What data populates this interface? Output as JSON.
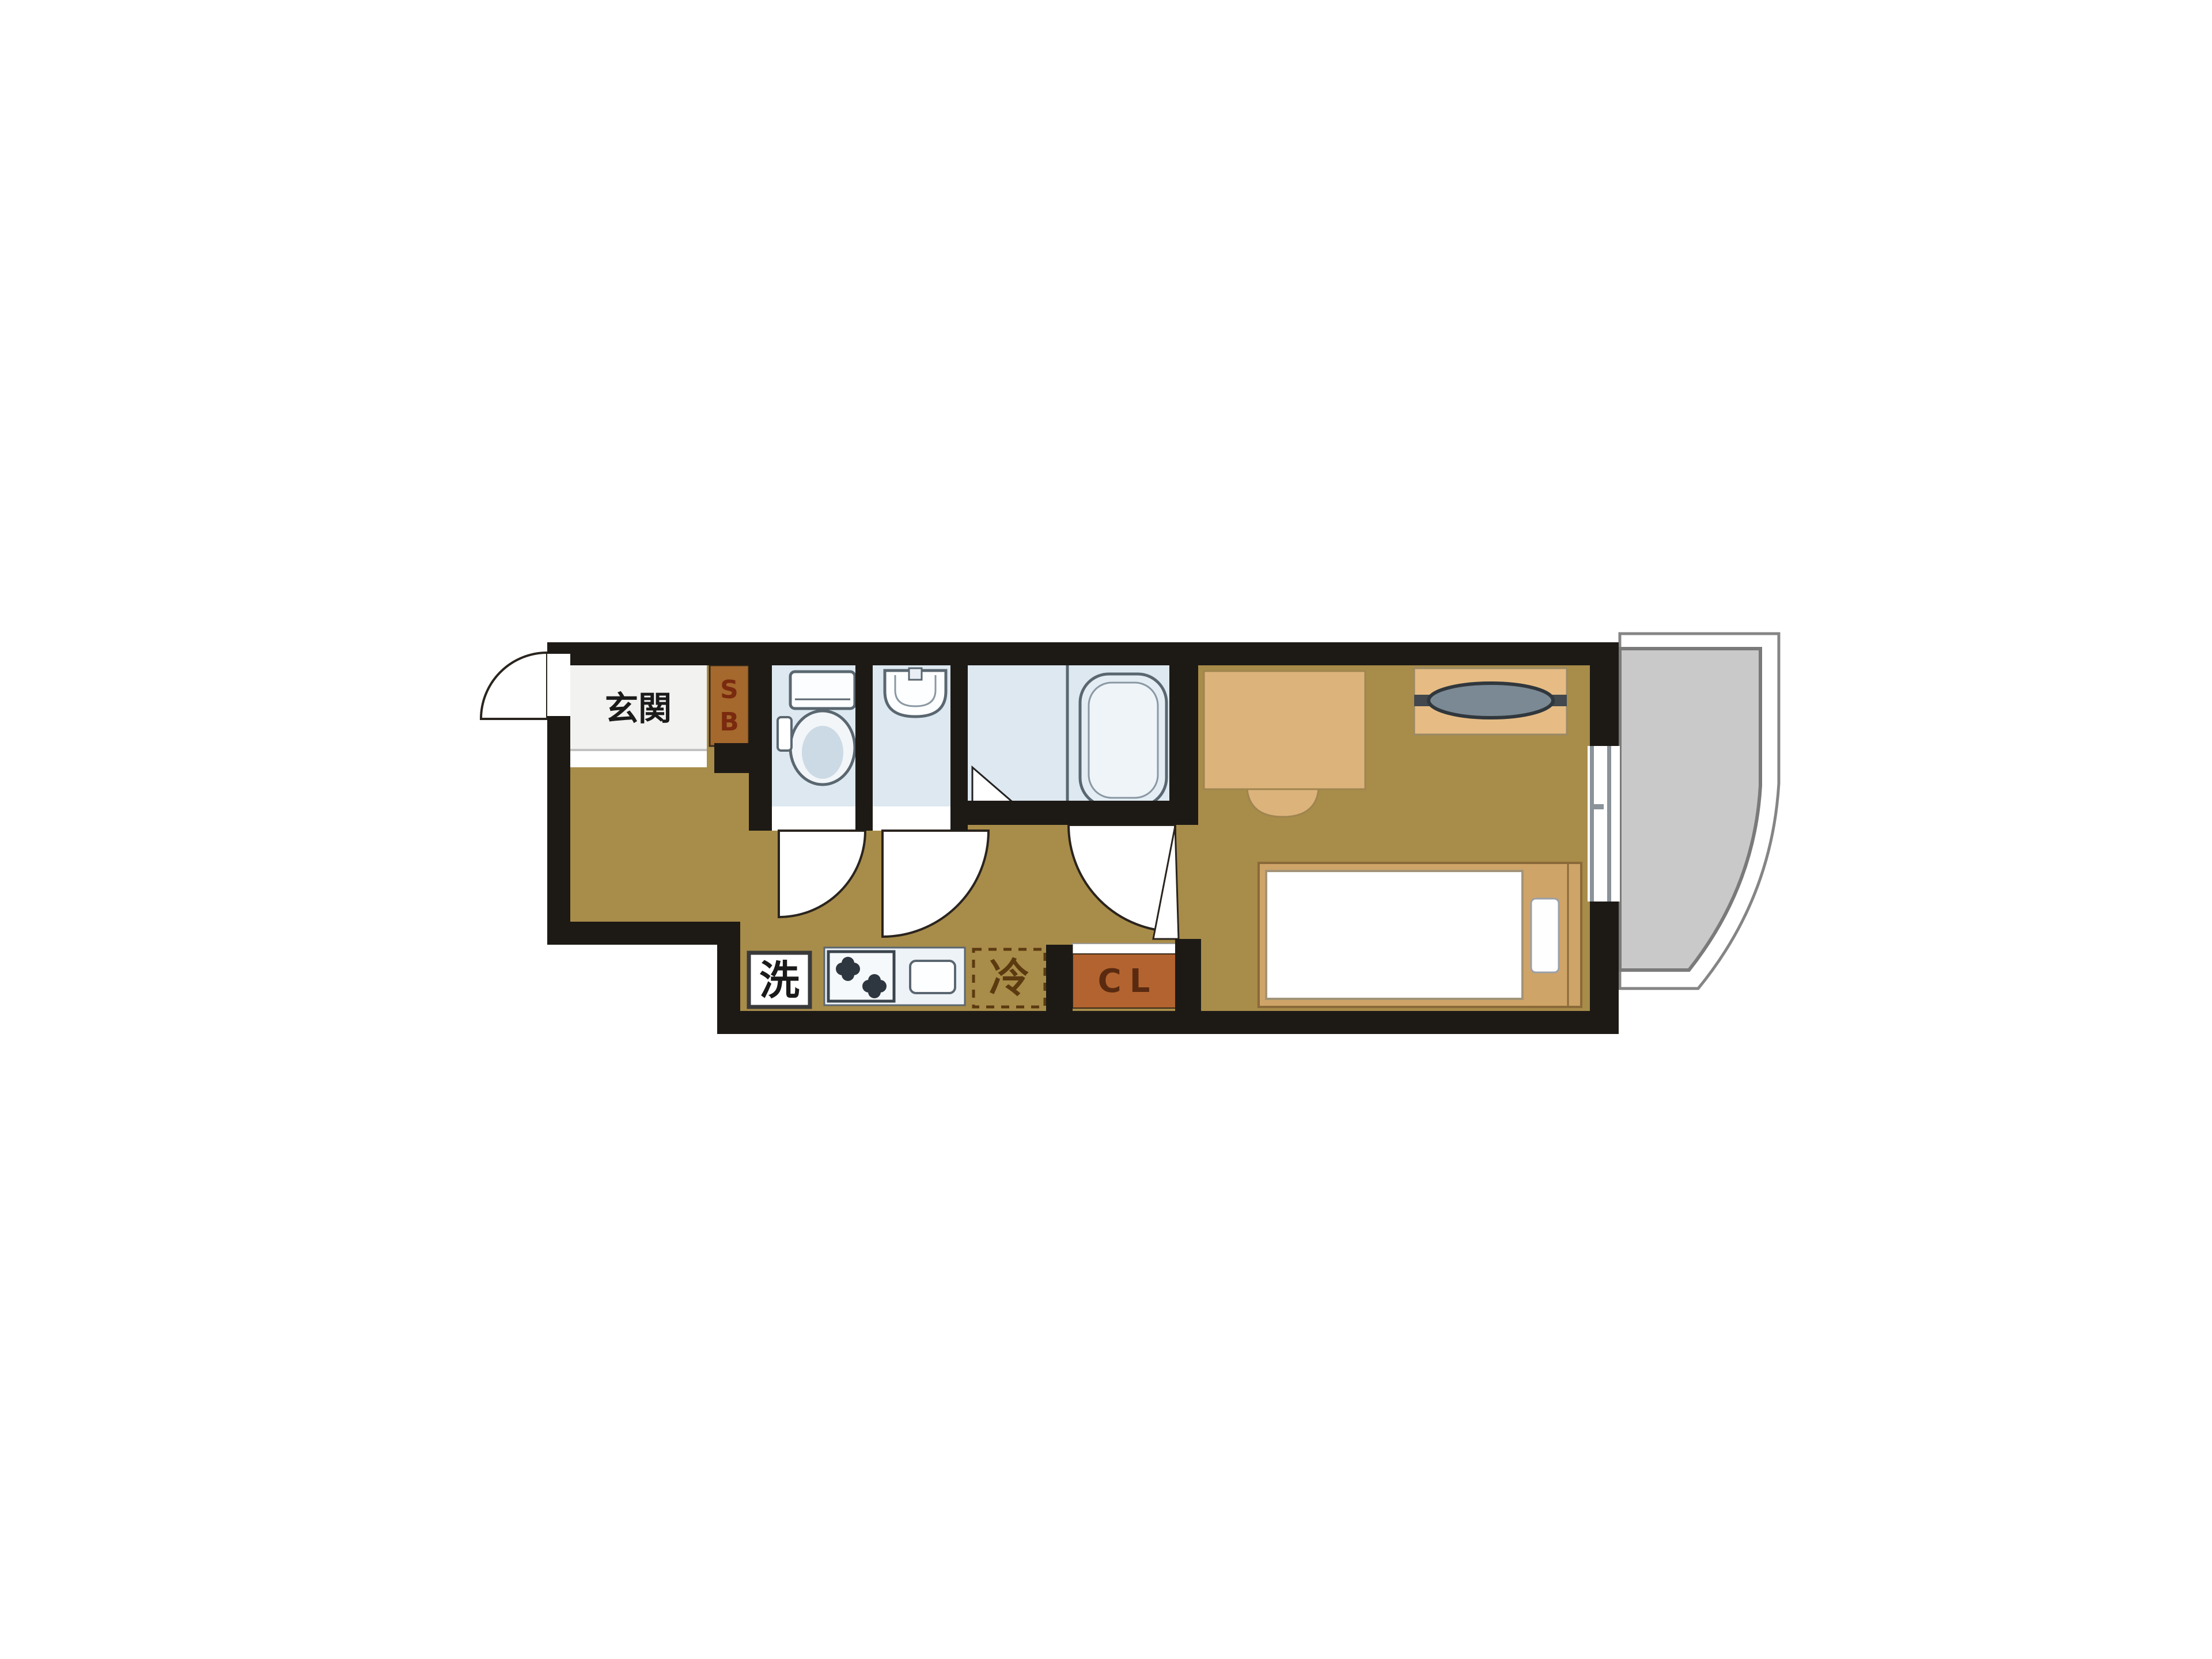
{
  "title": "studio apartment floor plan",
  "floorplan": {
    "labels": {
      "entrance": "玄関",
      "shoe_box_top": "S",
      "shoe_box_bottom": "B",
      "washer": "洗",
      "refrigerator": "冷",
      "closet": "CL"
    },
    "colors": {
      "wall": "#1d1a16",
      "floor": "#a88c49",
      "wet_room_floor": "#dde8f0",
      "entrance_floor": "#f2f2f0",
      "furniture_light": "#ddb37c",
      "bed_frame": "#cfa468",
      "closet": "#b2632f",
      "shoe_box": "#a5682d",
      "refrigerator_dash": "#5c3a10",
      "balcony_floor": "#c9c9c9",
      "fixture_outline": "#5a6770"
    }
  }
}
